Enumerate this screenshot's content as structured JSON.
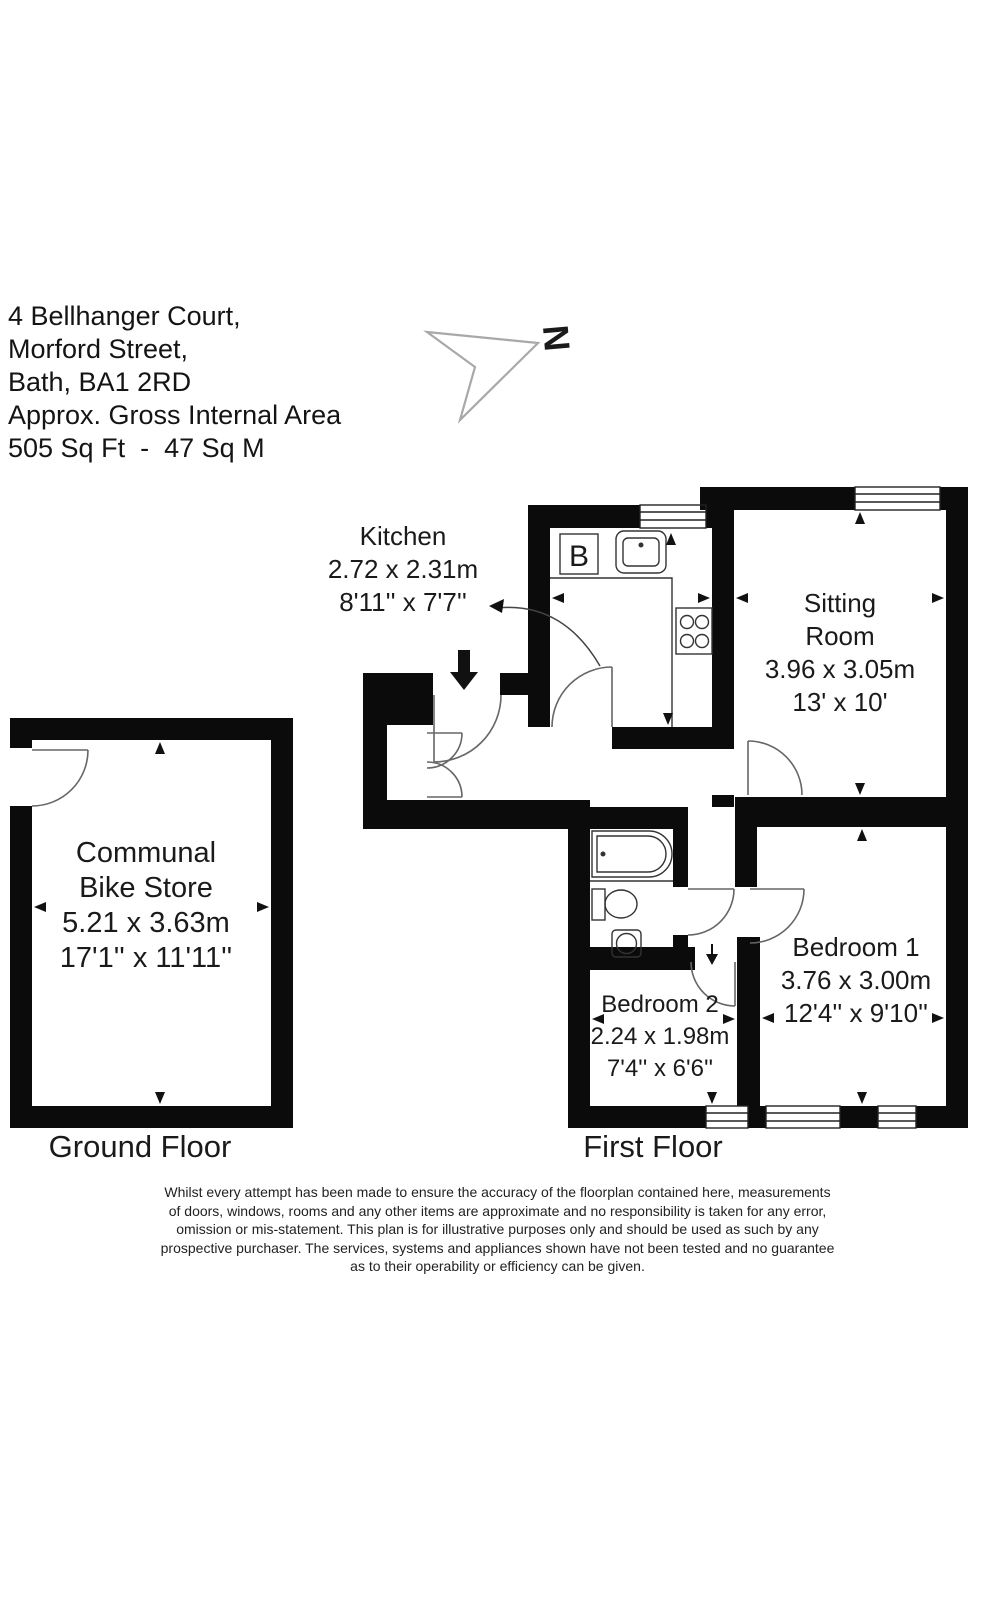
{
  "header": {
    "address_line1": "4 Bellhanger Court,",
    "address_line2": "Morford Street,",
    "address_line3": "Bath, BA1 2RD",
    "area_label": "Approx. Gross Internal Area",
    "area_value": "505 Sq Ft  -  47 Sq M"
  },
  "north_indicator": {
    "letter": "N"
  },
  "ground_floor": {
    "label": "Ground Floor",
    "bike_store": {
      "name_line1": "Communal",
      "name_line2": "Bike Store",
      "dims_metric": "5.21 x 3.63m",
      "dims_imperial": "17'1'' x 11'11''"
    }
  },
  "first_floor": {
    "label": "First Floor",
    "boiler_label": "B",
    "kitchen": {
      "name": "Kitchen",
      "dims_metric": "2.72 x 2.31m",
      "dims_imperial": "8'11'' x 7'7''"
    },
    "sitting_room": {
      "name_line1": "Sitting",
      "name_line2": "Room",
      "dims_metric": "3.96 x 3.05m",
      "dims_imperial": "13' x 10'"
    },
    "bedroom1": {
      "name": "Bedroom 1",
      "dims_metric": "3.76 x 3.00m",
      "dims_imperial": "12'4'' x 9'10''"
    },
    "bedroom2": {
      "name": "Bedroom 2",
      "dims_metric": "2.24 x 1.98m",
      "dims_imperial": "7'4'' x 6'6''"
    }
  },
  "disclaimer": {
    "line1": "Whilst every attempt has been made to ensure the accuracy of the floorplan contained here, measurements",
    "line2": "of doors, windows, rooms and any other items are approximate and no responsibility is taken for any error,",
    "line3": "omission or mis-statement. This plan is for illustrative purposes only and should be used as such by any",
    "line4": "prospective purchaser. The services, systems and appliances shown have not been tested and no guarantee",
    "line5": "as to their operability or efficiency can be given."
  },
  "colors": {
    "wall": "#0b0b0b",
    "line": "#555555",
    "text": "#1a1a1a",
    "background": "#ffffff"
  }
}
